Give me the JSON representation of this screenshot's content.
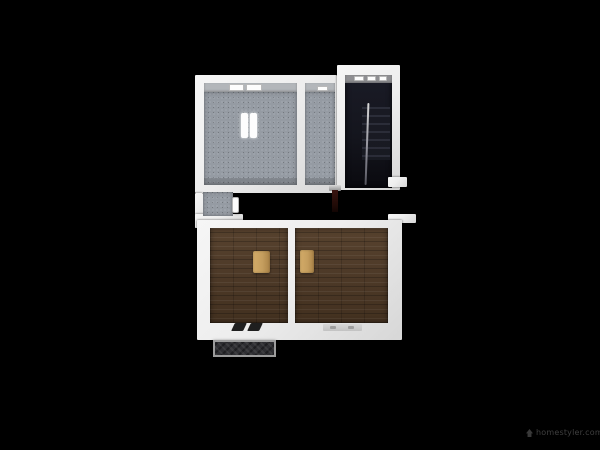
{
  "watermark": {
    "text": "homestyler.com",
    "icon": "homestyler-logo-icon"
  },
  "colors": {
    "background": "#000000",
    "wall": "#eeeeee",
    "wall-shade": "#d7d7d7",
    "wall-face": "#b3b6ba",
    "carpet": "#959ba3",
    "wood": "#4f3b29",
    "wood-dark": "#42301f",
    "stair-floor": "#14151d",
    "step-edge": "#2c2e3a",
    "rug": "#c59e5e",
    "stoop-frame": "#9c9c9c",
    "stoop-fill": "#2e2e32",
    "newel": "#3a1410",
    "watermark-text": "#3f3f3f"
  }
}
